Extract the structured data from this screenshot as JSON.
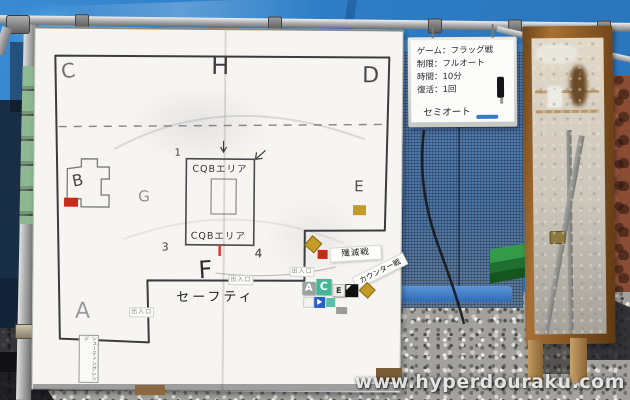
{
  "watermark": "www.hyperdouraku.com",
  "rules_board": {
    "line1": "ゲーム：フラッグ戦",
    "line2": "制限：フルオート",
    "line3": "時間：10分",
    "line4": "復活：1回",
    "note": "セミオート"
  },
  "map_board": {
    "zone_a": "A",
    "zone_b": "B",
    "zone_c": "C",
    "zone_d": "D",
    "zone_e": "E",
    "zone_f": "F",
    "zone_g": "G",
    "zone_h": "H",
    "cqb_top": "CQBエリア",
    "cqb_bottom": "CQBエリア",
    "num_1": "1",
    "num_3": "3",
    "num_4": "4",
    "safety_label": "セーフティ",
    "entrance_left": "出入口",
    "entrance_center": "出入口",
    "entrance_right": "出入口",
    "range_label": "シューティングレンジ",
    "tag_annihilation": "殲滅戦",
    "tag_counter": "カウンター戦",
    "magnet_a": "A",
    "magnet_c": "C",
    "magnet_e": "E"
  },
  "colors": {
    "tarp_blue": "#2e7ec6",
    "board_white": "#f6f5f1",
    "wood_frame": "#8a5a28",
    "marker_red": "#cc2818",
    "marker_gold": "#c49a28",
    "marker_teal": "#43b796",
    "marker_blue": "#2a5fc4"
  }
}
